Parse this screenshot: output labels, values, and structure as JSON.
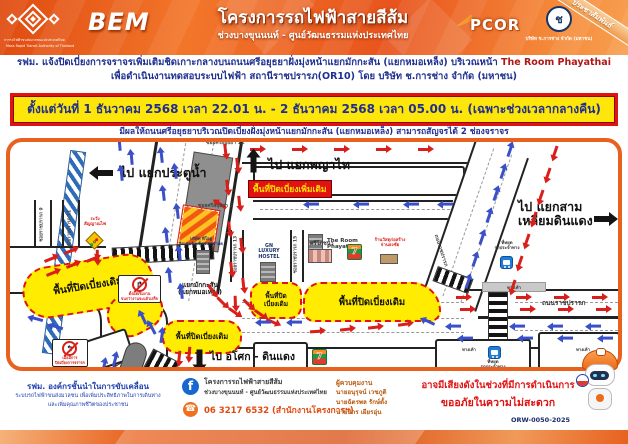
{
  "header": {
    "mrta_name_th": "การรถไฟฟ้าขนส่งมวลชนแห่งประเทศไทย",
    "mrta_name_en": "Mass Rapid Transit Authority of Thailand",
    "bem": "BEM",
    "title": "โครงการรถไฟฟ้าสายสีส้ม",
    "subtitle": "ช่วงบางขุนนนท์ - ศูนย์วัฒนธรรมแห่งประเทศไทย",
    "pcor": "PCOR",
    "ck_mark": "ช",
    "ck_name": "บริษัท ช.การช่าง จำกัด (มหาชน)",
    "ribbon": "ประชาสัมพันธ์"
  },
  "announcement": {
    "line1_a": "รฟม. แจ้งปิดเบี่ยงการจราจรเพิ่มเติมชิดเกาะกลางบนถนนศรีอยุธยาฝั่งมุ่งหน้าแยกมักกะสัน (แยกหมอเหล็ง) บริเวณหน้า",
    "line1_b": "The Room Phayathai",
    "line2": "เพื่อดำเนินงานทดสอบระบบไฟฟ้า สถานีราชปรารภ(OR10) โดย บริษัท ช.การช่าง จำกัด (มหาชน)",
    "period": "ตั้งแต่วันที่ 1 ธันวาคม 2568 เวลา 22.01 น. - 2 ธันวาคม 2568 เวลา 05.00 น. (เฉพาะช่วงเวลากลางคืน)",
    "effect": "มีผลให้ถนนศรีอยุธยาบริเวณปิดเบี่ยงฝั่งมุ่งหน้าแยกมักกะสัน (แยกหมอเหล็ง) สามารถสัญจรได้ 2 ช่องจราจร"
  },
  "map": {
    "labels": {
      "to_pratunam": "ไป แยกประตูน้ำ",
      "to_phayathai": "ไป แยกพญาไท",
      "to_samliam_1": "ไป แยกสาม",
      "to_samliam_2": "เหลี่ยมดินแดง",
      "to_asok": "ไป อโศก - ดินแดง",
      "soi_sri_12": "ซอยศรีอยุธยา 12",
      "soi_sri_2": "ซอยศรีอยุธยา 2",
      "soi_rat_9": "ซอยราชปรารภ 9",
      "soi_rat_11": "ซอยราชปรารภ 11",
      "soi_rat_13": "ซอยราชปรารภ 13",
      "soi_rat_15": "ซอยราชปรารภ 15",
      "rd_ratchaprarop": "ถนนราชปรารภ",
      "junction_1": "แยกมักกะสัน",
      "junction_2": "(แยกหมอเหล็ง)",
      "closure_new": "พื้นที่ปิดเบี่ยงเพิ่มเติม",
      "closure_old": "พื้นที่ปิดเบี่ยงเดิม",
      "closure_old_2l_1": "พื้นที่ปิด",
      "closure_old_2l_2": "เบี่ยงเดิม",
      "the_room_1": "The Room",
      "the_room_2": "Phayathai",
      "gn_1": "GN",
      "gn_2": "LUXURY",
      "gn_3": "HOSTEL",
      "company_1": "บริษัท ทีโอยู",
      "company_2": "อินเตอร์เนชั่นแนล จำกัด",
      "restaurant": "ศรีโภชนา",
      "material_1": "ร้านวัสดุก่อสร้าง",
      "material_2": "จ่านธงชัย",
      "hotel": "โรงแรมพรรณราย",
      "seven": "7",
      "bus_1": "ที่หยุด",
      "bus_2": "รถประจำทาง",
      "sidewalk": "ทางเท้า",
      "warn_1": "ระวัง",
      "warn_2": "สัญญาณไฟ",
      "no_right_cap_1": "ตั้งแต่เริ่มงาน",
      "no_right_cap_2": "จนกว่างานจะแล้วเสร็จ",
      "no_left_cap_1": "เมื่อมีการ",
      "no_left_cap_2": "ปิดเบี่ยงการจราจร"
    },
    "arrows": [
      [
        146,
        14,
        -96,
        "b"
      ],
      [
        160,
        30,
        -96,
        "b"
      ],
      [
        148,
        52,
        -96,
        "b"
      ],
      [
        162,
        70,
        -96,
        "b"
      ],
      [
        151,
        94,
        -96,
        "b"
      ],
      [
        164,
        112,
        -96,
        "b"
      ],
      [
        154,
        134,
        -96,
        "b"
      ],
      [
        166,
        150,
        -96,
        "b"
      ],
      [
        104,
        2,
        -95,
        "b"
      ],
      [
        116,
        16,
        -95,
        "b"
      ],
      [
        106,
        32,
        -95,
        "b"
      ],
      [
        210,
        6,
        84,
        "r"
      ],
      [
        222,
        20,
        84,
        "r"
      ],
      [
        212,
        42,
        84,
        "r"
      ],
      [
        224,
        58,
        84,
        "r"
      ],
      [
        214,
        84,
        84,
        "r"
      ],
      [
        226,
        100,
        84,
        "r"
      ],
      [
        216,
        124,
        84,
        "r"
      ],
      [
        228,
        140,
        84,
        "r"
      ],
      [
        220,
        158,
        88,
        "r"
      ],
      [
        240,
        6,
        0,
        "r"
      ],
      [
        282,
        6,
        0,
        "r"
      ],
      [
        324,
        6,
        0,
        "r"
      ],
      [
        366,
        6,
        0,
        "r"
      ],
      [
        408,
        6,
        0,
        "r"
      ],
      [
        298,
        61,
        180,
        "b"
      ],
      [
        348,
        61,
        180,
        "b"
      ],
      [
        398,
        61,
        180,
        "b"
      ],
      [
        432,
        61,
        180,
        "b"
      ],
      [
        494,
        8,
        -71,
        "b"
      ],
      [
        487,
        30,
        -71,
        "b"
      ],
      [
        480,
        52,
        -71,
        "b"
      ],
      [
        473,
        74,
        -71,
        "b"
      ],
      [
        466,
        96,
        -71,
        "b"
      ],
      [
        459,
        118,
        -71,
        "b"
      ],
      [
        452,
        140,
        -71,
        "b"
      ],
      [
        540,
        8,
        109,
        "r"
      ],
      [
        533,
        30,
        109,
        "r"
      ],
      [
        526,
        52,
        109,
        "r"
      ],
      [
        519,
        74,
        109,
        "r"
      ],
      [
        512,
        96,
        109,
        "r"
      ],
      [
        505,
        118,
        109,
        "r"
      ],
      [
        498,
        142,
        109,
        "r"
      ],
      [
        446,
        154,
        0,
        "r"
      ],
      [
        506,
        154,
        0,
        "r"
      ],
      [
        544,
        154,
        0,
        "r"
      ],
      [
        582,
        154,
        0,
        "r"
      ],
      [
        450,
        166,
        0,
        "r"
      ],
      [
        510,
        166,
        0,
        "r"
      ],
      [
        548,
        166,
        0,
        "r"
      ],
      [
        586,
        166,
        0,
        "r"
      ],
      [
        440,
        183,
        180,
        "b"
      ],
      [
        504,
        183,
        180,
        "b"
      ],
      [
        542,
        183,
        180,
        "b"
      ],
      [
        580,
        183,
        180,
        "b"
      ],
      [
        452,
        195,
        180,
        "b"
      ],
      [
        512,
        195,
        180,
        "b"
      ],
      [
        552,
        195,
        180,
        "b"
      ],
      [
        592,
        195,
        180,
        "b"
      ],
      [
        414,
        179,
        205,
        "b"
      ],
      [
        196,
        146,
        55,
        "r"
      ],
      [
        206,
        158,
        45,
        "r"
      ],
      [
        218,
        168,
        35,
        "r"
      ],
      [
        232,
        160,
        45,
        "r"
      ],
      [
        244,
        170,
        35,
        "r"
      ],
      [
        256,
        178,
        25,
        "r"
      ],
      [
        300,
        188,
        -4,
        "r"
      ],
      [
        330,
        186,
        -6,
        "r"
      ],
      [
        358,
        184,
        -6,
        "r"
      ],
      [
        388,
        181,
        -8,
        "r"
      ],
      [
        250,
        179,
        180,
        "b"
      ],
      [
        281,
        179,
        180,
        "b"
      ],
      [
        34,
        116,
        -22,
        "r"
      ],
      [
        54,
        108,
        -22,
        "r"
      ],
      [
        36,
        130,
        -22,
        "r"
      ],
      [
        56,
        122,
        -22,
        "r"
      ],
      [
        76,
        116,
        -22,
        "r"
      ],
      [
        82,
        112,
        90,
        "r"
      ],
      [
        58,
        211,
        0,
        "r"
      ],
      [
        164,
        213,
        96,
        "r"
      ],
      [
        174,
        209,
        96,
        "r"
      ],
      [
        88,
        224,
        -75,
        "b"
      ],
      [
        99,
        218,
        -75,
        "b"
      ],
      [
        146,
        194,
        -82,
        "b"
      ],
      [
        128,
        176,
        -115,
        "b"
      ],
      [
        137,
        186,
        -118,
        "b"
      ],
      [
        22,
        176,
        195,
        "b"
      ],
      [
        42,
        184,
        198,
        "b"
      ]
    ],
    "big_arrows": [
      [
        88,
        28,
        180
      ],
      [
        236,
        20,
        -90
      ],
      [
        584,
        74,
        0
      ],
      [
        182,
        212,
        90
      ]
    ]
  },
  "footer": {
    "tagline_1": "รฟม. องค์กรชั้นนำในการขับเคลื่อน",
    "tagline_2": "ระบบรถไฟฟ้าขนส่งมวลชน เพื่อเพิ่มประสิทธิภาพในการเดินทาง",
    "tagline_3": "และเพิ่มคุณภาพชีวิตของประชาชน",
    "fb_icon": "f",
    "fb_1": "โครงการรถไฟฟ้าสายสีส้ม",
    "fb_2": "ช่วงบางขุนนนท์ - ศูนย์วัฒนธรรมแห่งประเทศไทย",
    "phone_icon": "☎",
    "phone": "06 3217 6532 (สำนักงานโครงการฯ)",
    "sup_title": "ผู้ควบคุมงาน",
    "sup_1": "นายอนุรุจน์ เวชภูติ",
    "sup_2": "นายฉัตรพล รักษ์ตั้ง",
    "sup_3": "นายนิกร เผียรอุ่น",
    "notice_1": "อาจมีเสียงดังในช่วงที่มีการดำเนินการ",
    "notice_2": "ขออภัยในความไม่สะดวก",
    "code": "ORW-0050-2025"
  },
  "colors": {
    "accent_orange": "#e8611e",
    "closure_yellow": "#ffec00",
    "alert_red": "#e01212",
    "text_navy": "#1f2f8f",
    "arrow_red": "#d81f1a",
    "arrow_blue": "#3a50c8"
  }
}
